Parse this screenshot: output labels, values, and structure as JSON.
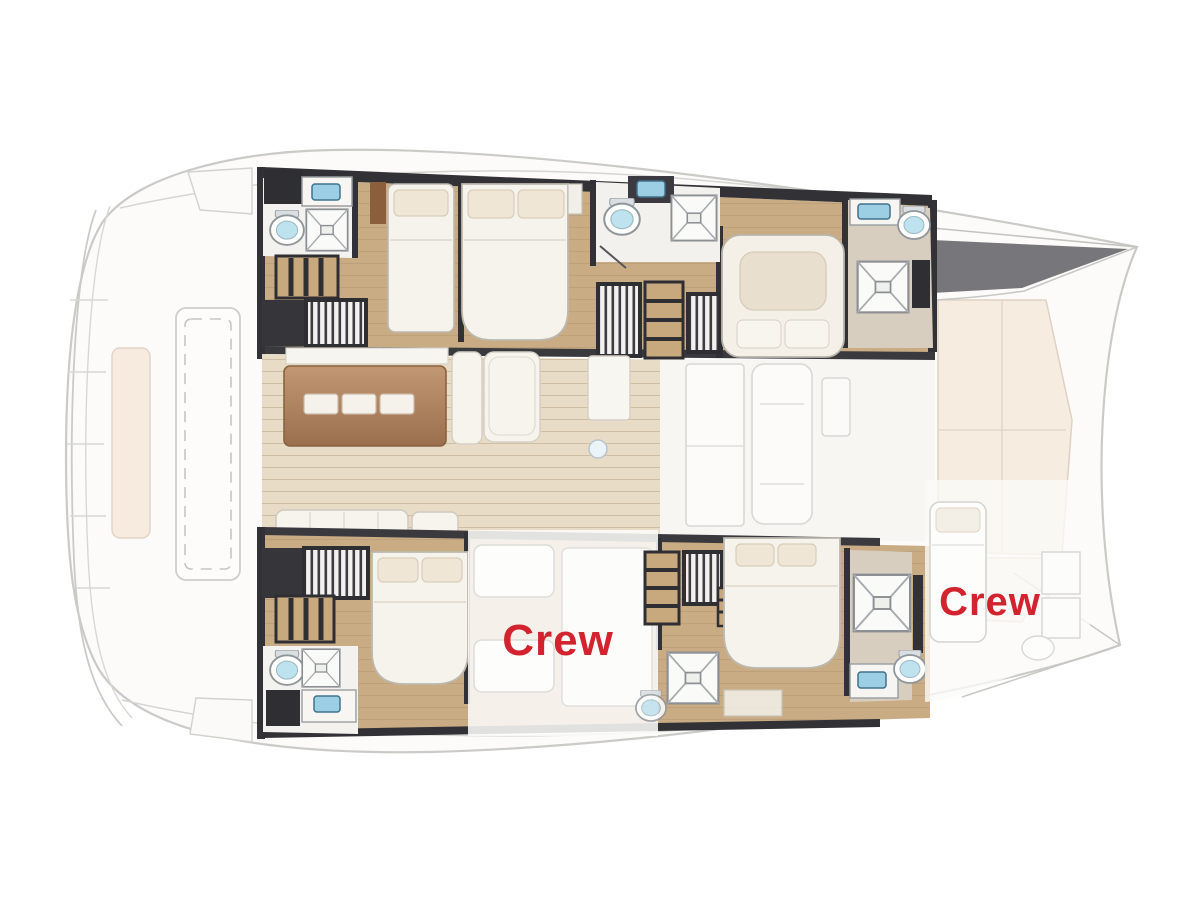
{
  "diagram": {
    "labels": {
      "crew_mid": "Crew",
      "crew_bow": "Crew"
    },
    "colors": {
      "crew_text": "#D2232E",
      "wall_dark": "#323236",
      "cabin_floor_wood": "#C9AC84",
      "salon_floor_wood": "#E9DCC6",
      "galley_island_wood": "#A97B54",
      "stair_wood": "#C8A87D",
      "fixture_blue": "#9CCFE3",
      "bed_linen": "#F6F3ED",
      "pillow": "#EFE6D6",
      "foredeck_cushion": "#F6EBDF",
      "exterior_outline": "#C8C8C4",
      "bathroom_floor": "#F3F2EE"
    }
  }
}
